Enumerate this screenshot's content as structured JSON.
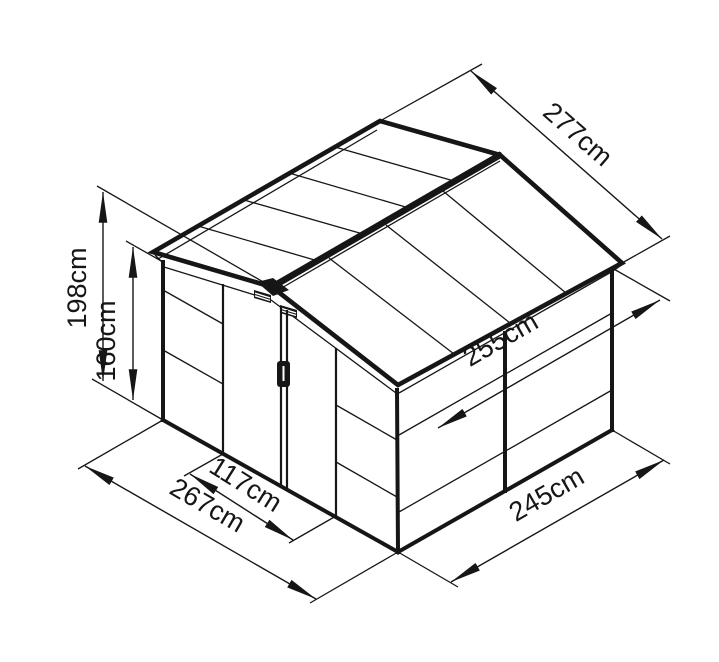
{
  "drawing": {
    "subject": "Garden shed isometric dimension drawing",
    "background_color": "#ffffff",
    "line_color": "#161616"
  },
  "dimensions": {
    "ridge_height": {
      "label": "198cm",
      "value": 198,
      "unit": "cm"
    },
    "wall_height": {
      "label": "160cm",
      "value": 160,
      "unit": "cm"
    },
    "roof_depth": {
      "label": "277cm",
      "value": 277,
      "unit": "cm"
    },
    "inner_width": {
      "label": "255cm",
      "value": 255,
      "unit": "cm"
    },
    "door_width": {
      "label": "117cm",
      "value": 117,
      "unit": "cm"
    },
    "front_width": {
      "label": "267cm",
      "value": 267,
      "unit": "cm"
    },
    "side_depth": {
      "label": "245cm",
      "value": 245,
      "unit": "cm"
    }
  }
}
